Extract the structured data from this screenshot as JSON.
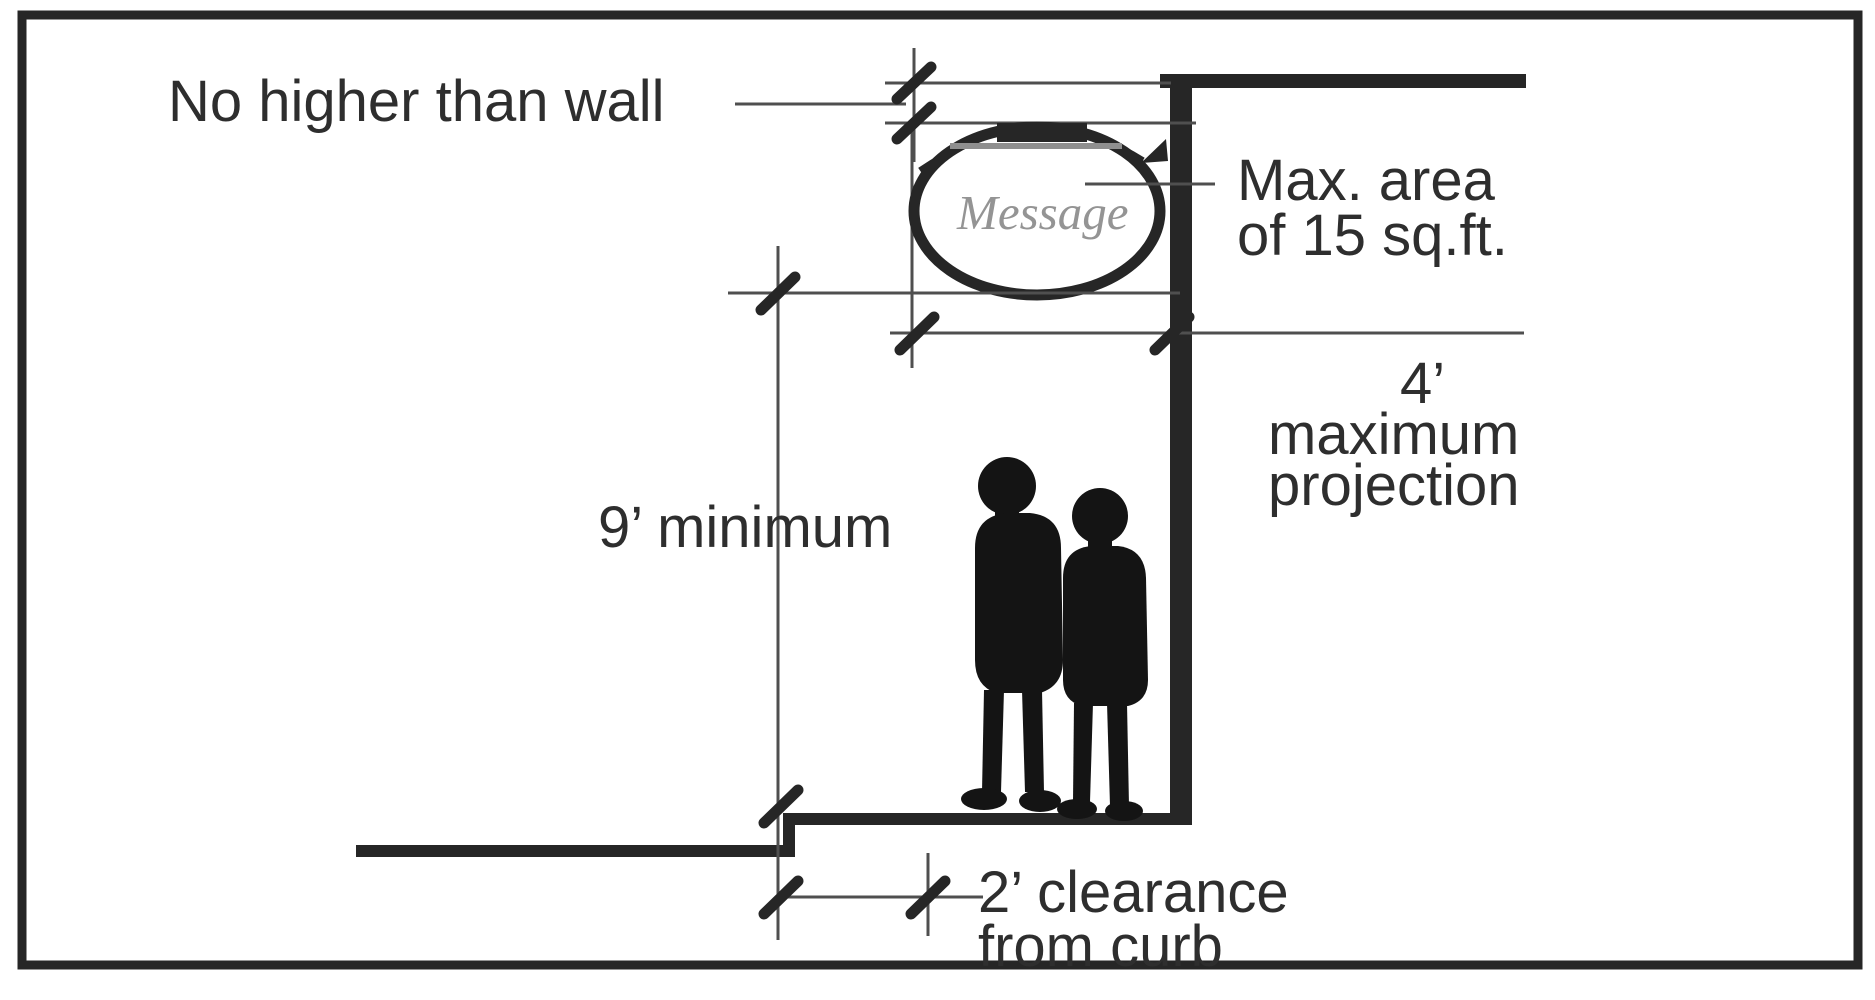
{
  "labels": {
    "no_higher": "No higher than wall",
    "max_area_line1": "Max. area",
    "max_area_line2": "of 15 sq.ft.",
    "projection_value": "4’",
    "projection_line2": "maximum",
    "projection_line3": "projection",
    "min_height": "9’ minimum",
    "clearance_line1": "2’ clearance",
    "clearance_line2": "from curb",
    "sign_message": "Message"
  },
  "colors": {
    "ink": "#262626",
    "dimension_line": "#4f4f4f",
    "sign_message_text": "#949494",
    "silhouette": "#141414",
    "background": "#ffffff"
  }
}
